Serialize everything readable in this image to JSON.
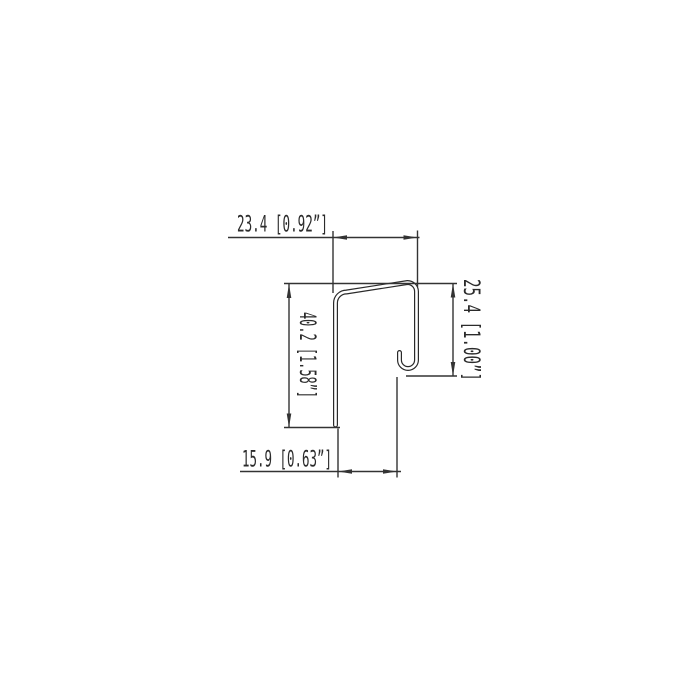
{
  "drawing": {
    "description": "Cross-section technical drawing of a J-shaped sheet profile with hooked return leg",
    "colors": {
      "background": "#ffffff",
      "line": "#333333",
      "profile_line": "#2a2a2a"
    },
    "dimensions": {
      "top_width": {
        "label": "23.4 [0.92”]",
        "mm": "23.4",
        "inches": "0.92”"
      },
      "overall_height": {
        "label": "40.2 [1.58”]",
        "mm": "40.2",
        "inches": "1.58”"
      },
      "right_height": {
        "label": "25.4 [1.00”]",
        "mm": "25.4",
        "inches": "1.00”"
      },
      "bottom_opening": {
        "label": "15.9 [0.63”]",
        "mm": "15.9",
        "inches": "0.63”"
      }
    }
  }
}
